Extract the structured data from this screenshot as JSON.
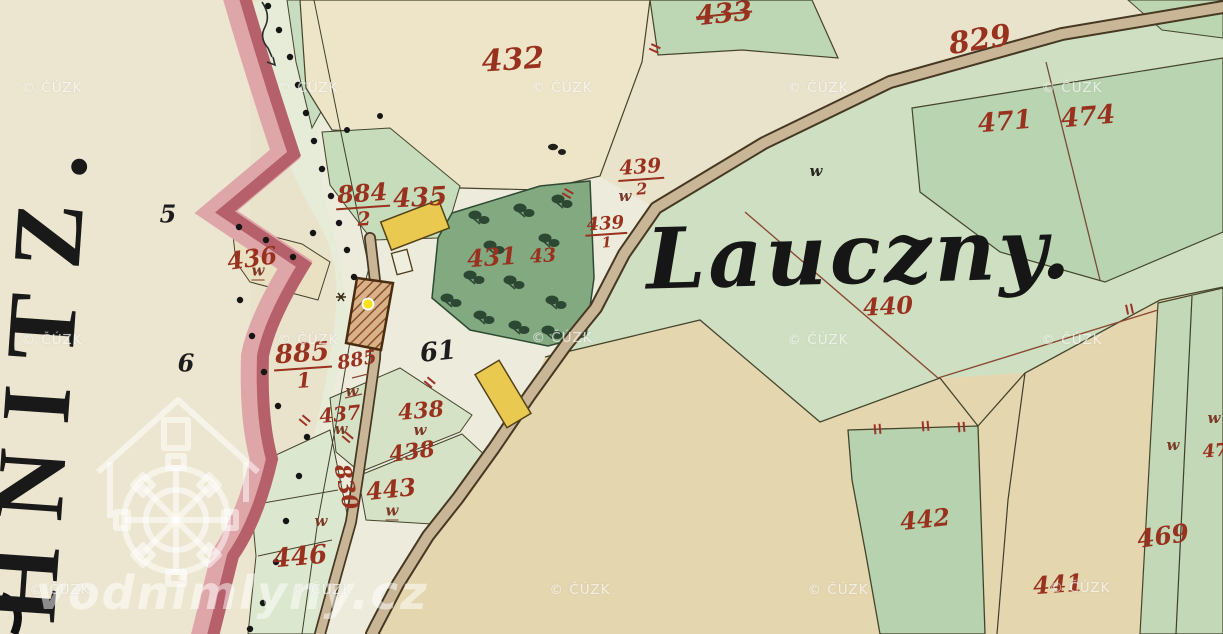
{
  "map": {
    "left_place_label": "HNITZ.",
    "area_label": "Lauczny.",
    "watermarks": {
      "cuzk": "© ČÚZK",
      "site": "vodnimlyny.cz",
      "cuzk_positions": [
        [
          52,
          88
        ],
        [
          308,
          88
        ],
        [
          562,
          88
        ],
        [
          818,
          88
        ],
        [
          1072,
          88
        ],
        [
          52,
          340
        ],
        [
          308,
          340
        ],
        [
          562,
          338
        ],
        [
          818,
          340
        ],
        [
          1072,
          340
        ],
        [
          60,
          590
        ],
        [
          322,
          590
        ],
        [
          580,
          590
        ],
        [
          838,
          590
        ],
        [
          1080,
          588
        ]
      ]
    },
    "parcel_labels": [
      {
        "t": "432",
        "x": 513,
        "y": 60,
        "s": 30,
        "r": -4,
        "strike": false
      },
      {
        "t": "433",
        "x": 724,
        "y": 14,
        "s": 27,
        "r": -6,
        "strike": true
      },
      {
        "t": "829",
        "x": 980,
        "y": 40,
        "s": 30,
        "r": -9,
        "strike": false
      },
      {
        "t": "471",
        "x": 1005,
        "y": 122,
        "s": 26,
        "r": -5,
        "strike": false
      },
      {
        "t": "474",
        "x": 1088,
        "y": 117,
        "s": 26,
        "r": -5,
        "strike": false
      },
      {
        "t": "435",
        "x": 420,
        "y": 198,
        "s": 26,
        "r": -3,
        "strike": false
      },
      {
        "t": "436",
        "x": 252,
        "y": 258,
        "s": 24,
        "r": -8,
        "strike": false
      },
      {
        "t": "431",
        "x": 492,
        "y": 257,
        "s": 24,
        "r": -4,
        "strike": false
      },
      {
        "t": "43",
        "x": 543,
        "y": 256,
        "s": 19,
        "r": -4,
        "strike": false
      },
      {
        "t": "440",
        "x": 888,
        "y": 306,
        "s": 24,
        "r": -3,
        "strike": false
      },
      {
        "t": "885",
        "x": 357,
        "y": 360,
        "s": 19,
        "r": -10,
        "strike": false
      },
      {
        "t": "437",
        "x": 340,
        "y": 414,
        "s": 20,
        "r": -6,
        "strike": false
      },
      {
        "t": "438",
        "x": 421,
        "y": 411,
        "s": 22,
        "r": -5,
        "strike": false
      },
      {
        "t": "438",
        "x": 412,
        "y": 452,
        "s": 22,
        "r": -8,
        "strike": false
      },
      {
        "t": "443",
        "x": 391,
        "y": 489,
        "s": 24,
        "r": -6,
        "strike": false
      },
      {
        "t": "830",
        "x": 346,
        "y": 487,
        "s": 22,
        "r": 78,
        "strike": false
      },
      {
        "t": "446",
        "x": 300,
        "y": 557,
        "s": 26,
        "r": -5,
        "strike": false
      },
      {
        "t": "442",
        "x": 925,
        "y": 519,
        "s": 24,
        "r": -6,
        "strike": false
      },
      {
        "t": "441",
        "x": 1058,
        "y": 584,
        "s": 24,
        "r": -4,
        "strike": false
      },
      {
        "t": "469",
        "x": 1163,
        "y": 536,
        "s": 25,
        "r": -8,
        "strike": false
      },
      {
        "t": "47",
        "x": 1215,
        "y": 451,
        "s": 18,
        "r": -5,
        "strike": false
      }
    ],
    "fraction_labels": [
      {
        "n": "439",
        "d": "2",
        "x": 641,
        "y": 177,
        "s": 20
      },
      {
        "n": "439",
        "d": "1",
        "x": 606,
        "y": 233,
        "s": 18
      },
      {
        "n": "884",
        "d": "2",
        "x": 363,
        "y": 205,
        "s": 24
      },
      {
        "n": "885",
        "d": "1",
        "x": 303,
        "y": 366,
        "s": 26
      }
    ],
    "black_labels": [
      {
        "t": "5",
        "x": 168,
        "y": 214,
        "s": 24,
        "r": 0
      },
      {
        "t": "6",
        "x": 186,
        "y": 363,
        "s": 24,
        "r": 0
      },
      {
        "t": "61",
        "x": 438,
        "y": 352,
        "s": 26,
        "r": -6
      }
    ],
    "meadow_marks": [
      {
        "x": 258,
        "y": 271,
        "black": false,
        "u": true
      },
      {
        "x": 625,
        "y": 196,
        "black": false,
        "u": false
      },
      {
        "x": 816,
        "y": 171,
        "black": true,
        "u": false
      },
      {
        "x": 420,
        "y": 430,
        "black": false,
        "u": false
      },
      {
        "x": 392,
        "y": 511,
        "black": false,
        "u": true
      },
      {
        "x": 341,
        "y": 429,
        "black": false,
        "u": false
      },
      {
        "x": 321,
        "y": 521,
        "black": false,
        "u": false
      },
      {
        "x": 352,
        "y": 391,
        "black": false,
        "u": false
      },
      {
        "x": 1173,
        "y": 445,
        "black": false,
        "u": false
      },
      {
        "x": 1214,
        "y": 418,
        "black": false,
        "u": false
      }
    ],
    "colors": {
      "paper": "#eae3cb",
      "parcel_beige": "#eee5c9",
      "green_light": "#cfe0c2",
      "green_mid": "#b9d4b0",
      "orchard_green": "#83a981",
      "field_tan": "#e4d6ae",
      "road_fill": "#c9b697",
      "stream_dark": "#b5606a",
      "stream_light": "#dfa6aa",
      "building_yellow": "#e9c94f",
      "mill_hatch": "#8a4f28",
      "label_red": "#98321f",
      "marker_yellow": "#ffe11a",
      "ink_black": "#1d1d1d"
    }
  }
}
